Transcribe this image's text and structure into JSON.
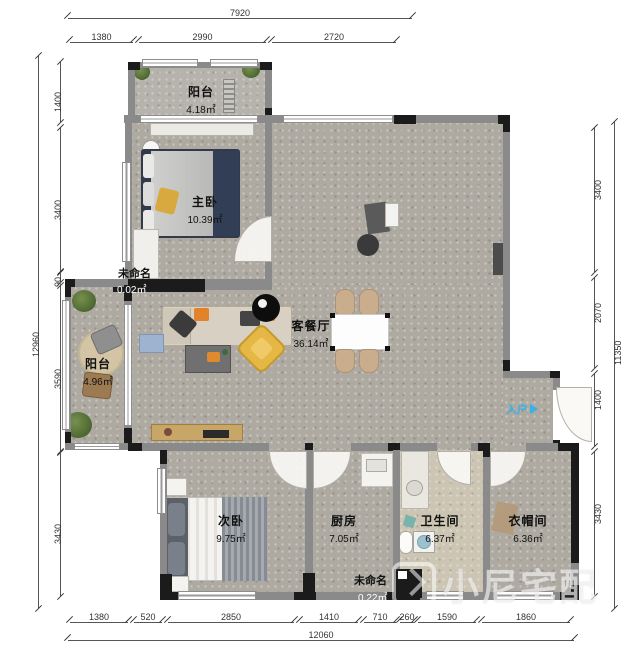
{
  "rooms": {
    "balcony_top": {
      "name": "阳台",
      "area": "4.18㎡"
    },
    "master": {
      "name": "主卧",
      "area": "10.39㎡"
    },
    "living": {
      "name": "客餐厅",
      "area": "36.14㎡"
    },
    "balcony_left": {
      "name": "阳台",
      "area": "4.96㎡"
    },
    "bedroom2": {
      "name": "次卧",
      "area": "9.75㎡"
    },
    "kitchen": {
      "name": "厨房",
      "area": "7.05㎡"
    },
    "bathroom": {
      "name": "卫生间",
      "area": "6.37㎡"
    },
    "cloakroom": {
      "name": "衣帽间",
      "area": "6.36㎡"
    },
    "unnamed1": {
      "name": "未命名",
      "area": "0.02㎡"
    },
    "unnamed2": {
      "name": "未命名",
      "area": "0.22㎡"
    }
  },
  "dimensions": {
    "top": {
      "total": "7920",
      "segments": [
        "1380",
        "2990",
        "2720"
      ]
    },
    "left": {
      "total": "12960",
      "segments": [
        "1400",
        "3400",
        "90",
        "3590",
        "3430"
      ]
    },
    "right": {
      "total": "11350",
      "segments": [
        "3400",
        "2070",
        "1400",
        "3430"
      ]
    },
    "bottom": {
      "total": "12060",
      "segments": [
        "1380",
        "520",
        "2850",
        "1410",
        "710",
        "260",
        "1590",
        "1860"
      ]
    }
  },
  "misc": {
    "entry_label": "入户",
    "watermark": "小尼宅配"
  },
  "colors": {
    "accent_entry": "#35b2e8",
    "wall": "#8a8a8a",
    "wall_dark": "#1b1b1b",
    "sofa": "#d8d1c3",
    "chair_yellow": "#e5b845",
    "pillow_orange": "#e2832c"
  }
}
